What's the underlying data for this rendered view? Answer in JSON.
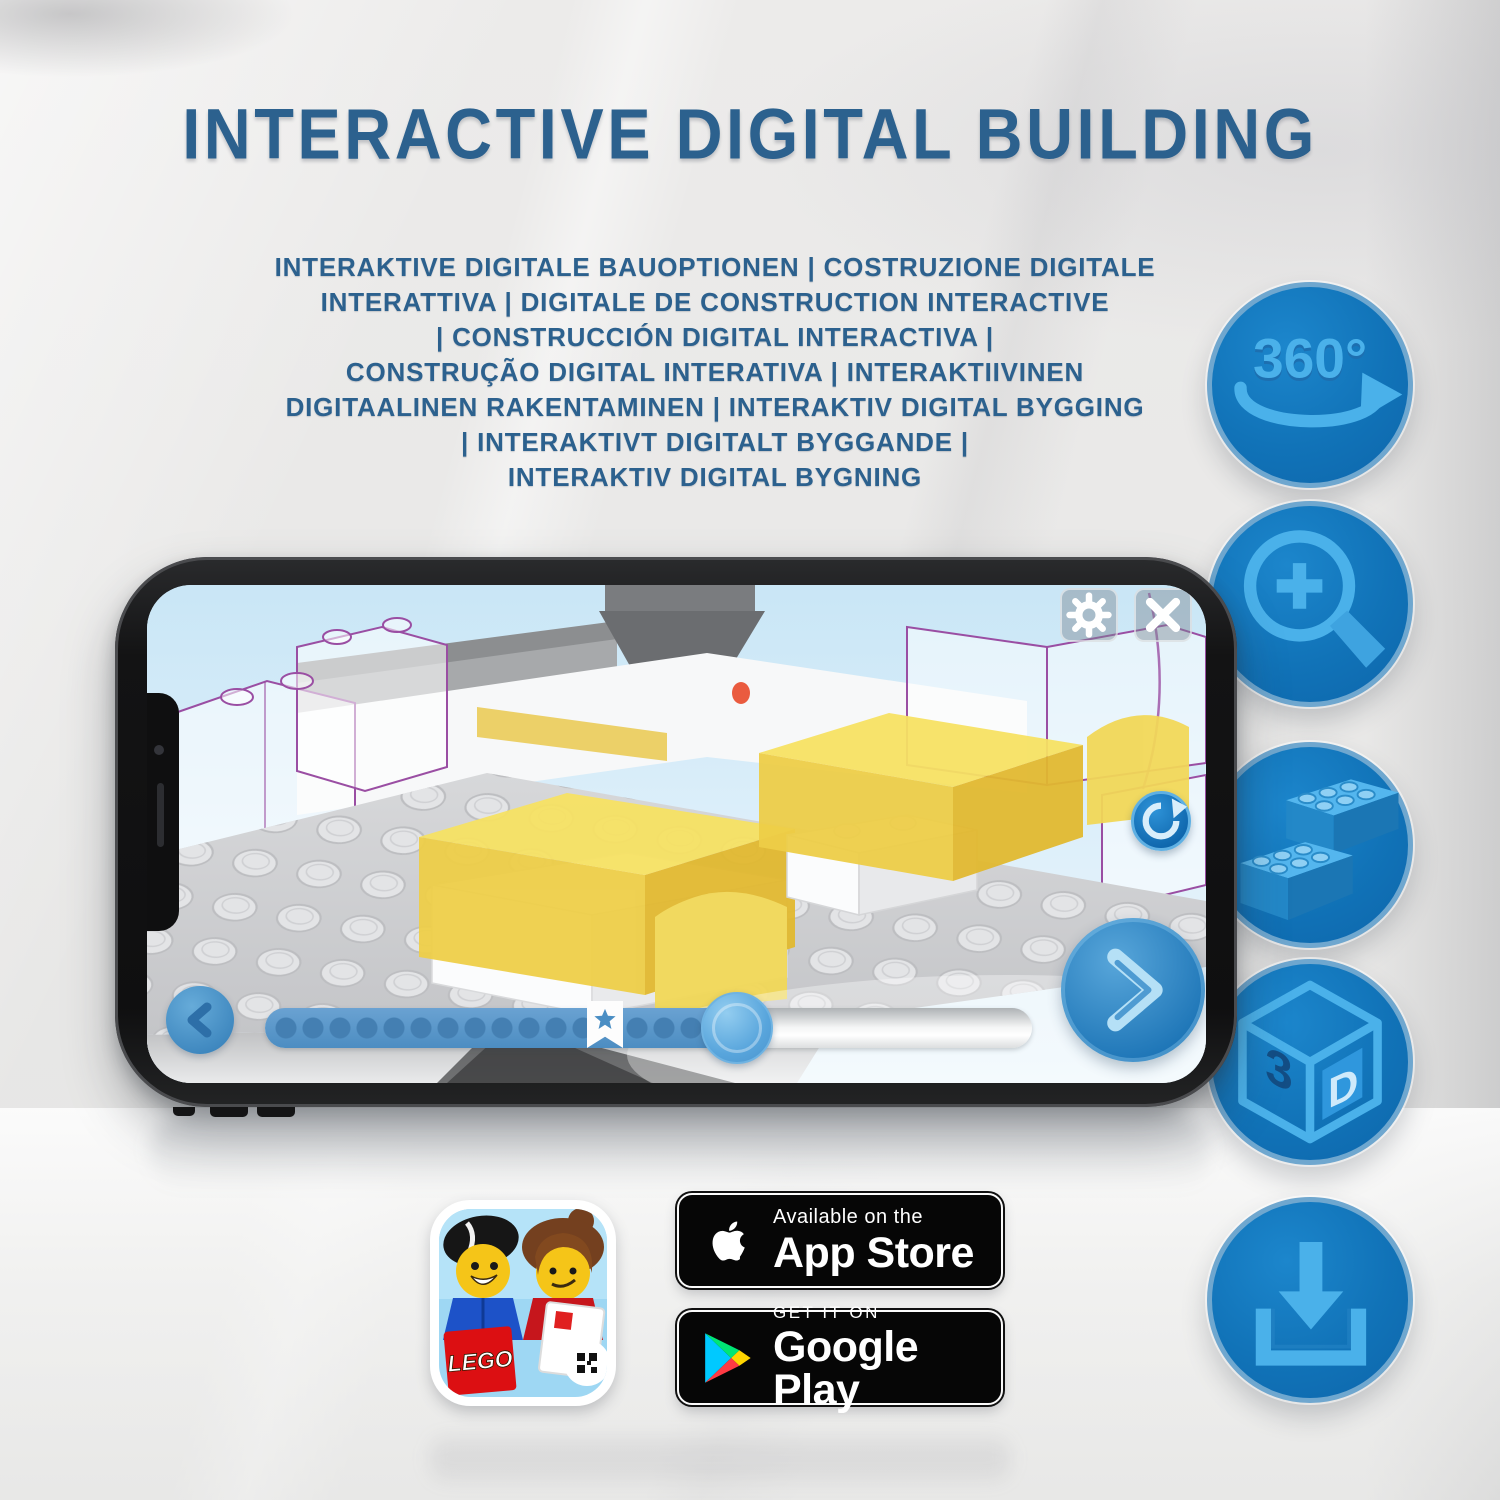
{
  "header": {
    "title": "INTERACTIVE DIGITAL BUILDING",
    "subtitle_lines": [
      "INTERAKTIVE DIGITALE BAUOPTIONEN | COSTRUZIONE DIGITALE",
      "INTERATTIVA | DIGITALE DE CONSTRUCTION INTERACTIVE",
      "| CONSTRUCCIÓN DIGITAL INTERACTIVA |",
      "CONSTRUÇÃO DIGITAL INTERATIVA | INTERAKTIIVINEN",
      "DIGITAALINEN RAKENTAMINEN | INTERAKTIV DIGITAL BYGGING",
      "| INTERAKTIVT DIGITALT BYGGANDE |",
      "INTERAKTIV DIGITAL BYGNING"
    ]
  },
  "features": {
    "rotate_label": "360°",
    "cube_digit": "3",
    "cube_letter": "D",
    "icon_names": [
      "360-rotation-icon",
      "zoom-in-icon",
      "brick-icon",
      "3d-cube-icon",
      "download-icon"
    ]
  },
  "badges": {
    "app_store": {
      "tagline": "Available on the",
      "name": "App Store"
    },
    "google_play": {
      "tagline": "GET IT ON",
      "name": "Google Play"
    }
  },
  "app_icon": {
    "logo": "LEGO"
  },
  "colors": {
    "title_blue": "#2c618e",
    "circle_blue": "#1173b8",
    "glyph_blue": "#4ab1ea",
    "lego_yellow": "#f2d94e",
    "lego_red": "#dc0f12"
  }
}
